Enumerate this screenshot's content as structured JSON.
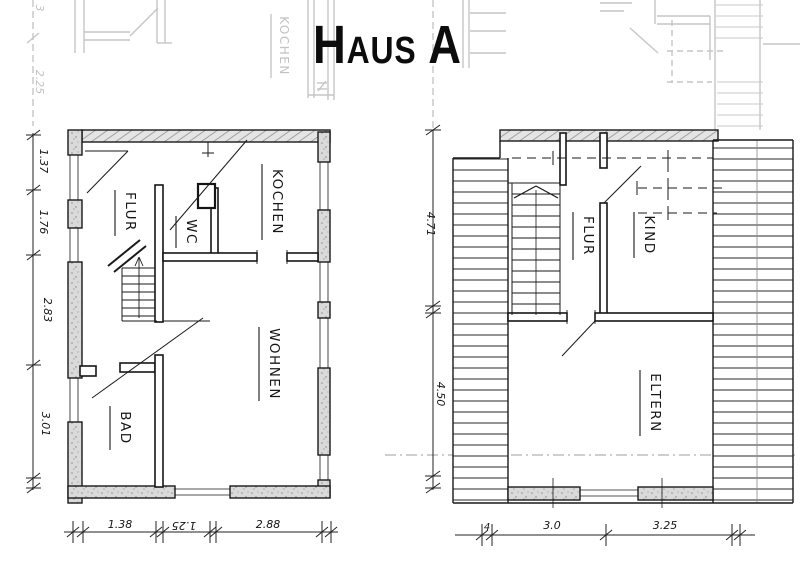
{
  "title": "Haus A",
  "colors": {
    "ink": "#1a1a1a",
    "wall_hatch": "#8f8f8f",
    "wall_fill": "#dcdcdc",
    "faded": "#c6c6c6"
  },
  "left_plan": {
    "rooms": [
      {
        "label": "FLUR"
      },
      {
        "label": "WC"
      },
      {
        "label": "KOCHEN"
      },
      {
        "label": "BAD"
      },
      {
        "label": "WOHNEN"
      }
    ],
    "dims_vertical": [
      "1.37",
      "1.76",
      "2.83",
      "3.01"
    ],
    "dims_bottom": [
      "1.38",
      "1.25",
      "2.88"
    ]
  },
  "right_plan": {
    "rooms": [
      {
        "label": "FLUR"
      },
      {
        "label": "KIND"
      },
      {
        "label": "ELTERN"
      }
    ],
    "dims_vertical": [
      "4.71",
      "4.50"
    ],
    "dims_bottom": [
      "4",
      "3.0",
      "3.25"
    ]
  },
  "faded_fragments": {
    "kochen_label": "KOCHEN",
    "dim_225": "2.25",
    "dim_partial": "3"
  }
}
